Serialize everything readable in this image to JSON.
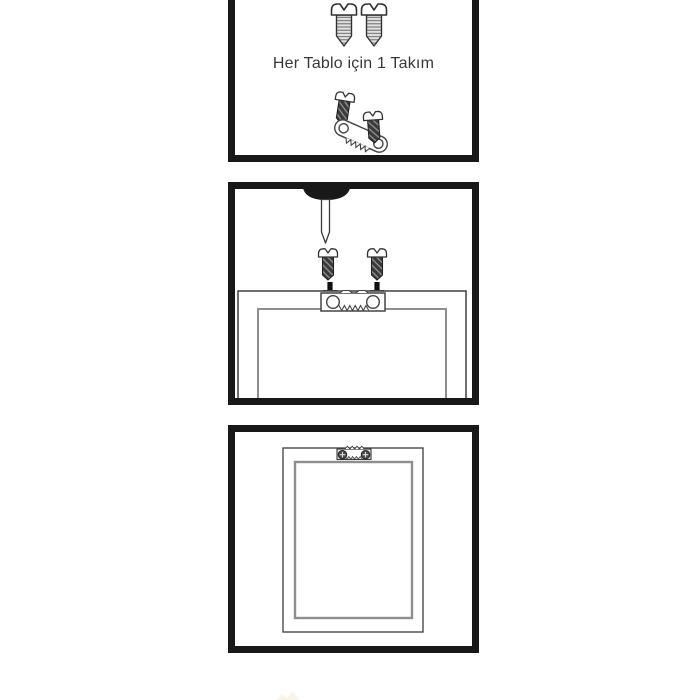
{
  "panels": [
    {
      "id": "step-1-kit",
      "caption": "Her Tablo için 1 Takım",
      "items": [
        "large-screw",
        "large-screw",
        "small-screw",
        "sawtooth-hanger",
        "small-screw"
      ]
    },
    {
      "id": "step-2-attach-hanger",
      "items": [
        "nail",
        "small-screw",
        "small-screw",
        "down-arrow",
        "down-arrow",
        "frame-back-top",
        "sawtooth-hanger"
      ]
    },
    {
      "id": "step-3-mounted",
      "items": [
        "frame-back",
        "sawtooth-hanger-mounted"
      ]
    }
  ],
  "colors": {
    "panel_border": "#181818",
    "outline_dark": "#3a3a3a",
    "outline_gray": "#8f8f8f",
    "screw_thread_fill": "#e2e2e2",
    "hardware_dark_fill": "#3a3a3a",
    "nail_head_fill": "#181818",
    "watermark_cream": "#faf4dd"
  }
}
